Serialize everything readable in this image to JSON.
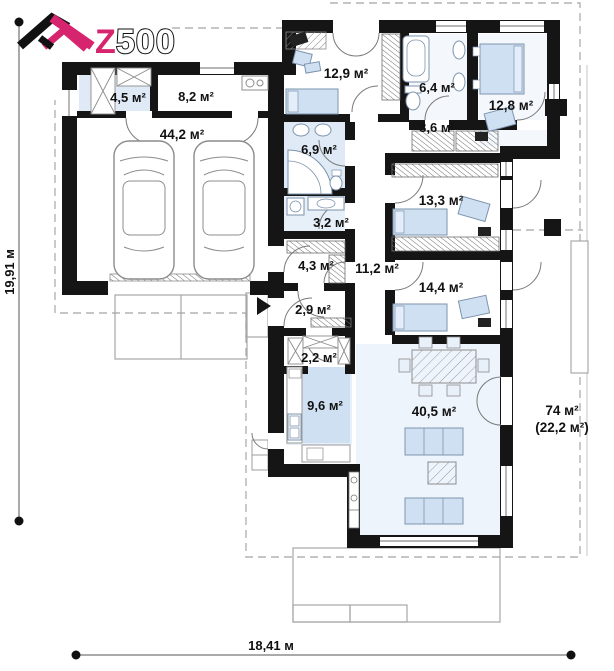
{
  "logo": {
    "letter": "Z",
    "numbers": "500"
  },
  "dimensions": {
    "height_label": "19,91 м",
    "width_label": "18,41 м"
  },
  "rooms": {
    "storage": "4,5 м²",
    "utility": "8,2 м²",
    "garage": "44,2 м²",
    "bedroom_top": "12,9 м²",
    "bathroom_main": "6,4 м²",
    "bedroom_right": "12,8 м²",
    "hall_wardrobe": "3,6 м²",
    "bathroom_left": "6,9 м²",
    "laundry": "3,2 м²",
    "bedroom_mid": "13,3 м²",
    "wardrobe": "4,3 м²",
    "corridor": "11,2 м²",
    "bedroom_low": "14,4 м²",
    "entry": "2,9 м²",
    "pantry": "2,2 м²",
    "kitchen": "9,6 м²",
    "living": "40,5 м²"
  },
  "terrace": {
    "total": "74 м²",
    "covered": "(22,2 м²)"
  },
  "colors": {
    "accent": "#d6246e",
    "wall": "#151515",
    "furniture_fill": "#cfe0f2",
    "tint": "#dfeaf6"
  }
}
